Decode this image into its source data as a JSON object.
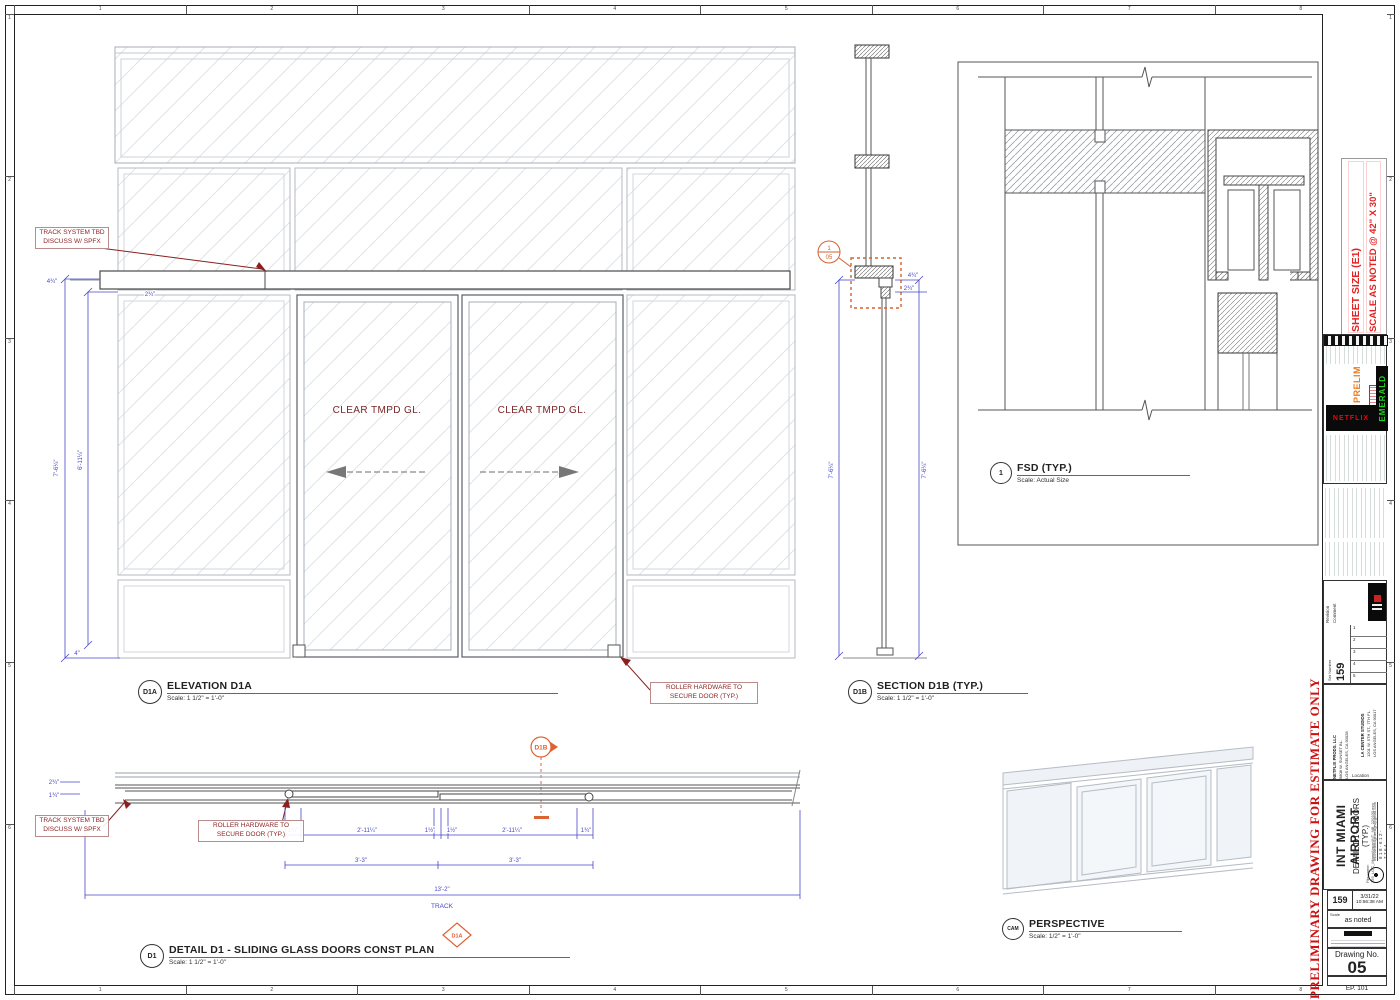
{
  "sheet": {
    "ruler_top": [
      "1",
      "2",
      "3",
      "4",
      "5",
      "6",
      "7",
      "8"
    ],
    "ruler_bottom": [
      "1",
      "2",
      "3",
      "4",
      "5",
      "6",
      "7",
      "8"
    ],
    "ruler_left": [
      "1",
      "2",
      "3",
      "4",
      "5",
      "6"
    ],
    "ruler_right": [
      "1",
      "2",
      "3",
      "4",
      "5",
      "6"
    ]
  },
  "colors": {
    "dim_blue": "#4747c9",
    "note_red": "#8b1f1f",
    "marker_orange": "#dd6333",
    "netflix_red": "#e50914",
    "emerald_green": "#22d022",
    "prelim_orange": "#e87c1e"
  },
  "annotations": {
    "track_note_1": "TRACK SYSTEM TBD",
    "track_note_2": "DISCUSS W/ SPFX",
    "roller_note_1": "ROLLER HARDWARE TO",
    "roller_note_2": "SECURE DOOR (TYP.)",
    "glass_label": "CLEAR TMPD GL.",
    "track_word": "TRACK"
  },
  "views": {
    "elevation": {
      "tag": "D1A",
      "title": "ELEVATION D1A",
      "scale": "Scale: 1 1/2\" = 1'-0\""
    },
    "section": {
      "tag": "D1B",
      "title": "SECTION D1B (TYP.)",
      "scale": "Scale: 1 1/2\" = 1'-0\"",
      "callout_top": "1",
      "callout_bottom": "05"
    },
    "fsd": {
      "tag": "1",
      "title": "FSD (TYP.)",
      "scale": "Scale: Actual Size"
    },
    "plan": {
      "tag": "D1",
      "title": "DETAIL D1 - SLIDING GLASS DOORS CONST PLAN",
      "scale": "Scale: 1 1/2\" = 1'-0\"",
      "marker_top": "D1B",
      "marker_bottom": "D1A"
    },
    "perspective": {
      "tag": "CAM",
      "title": "PERSPECTIVE",
      "scale": "Scale: 1/2\" = 1'-0\""
    }
  },
  "dims": {
    "elev_top_a": "4¾\"",
    "elev_top_b": "2¾\"",
    "elev_h_outer": "7'-6¼\"",
    "elev_h_inner": "6'-11¼\"",
    "elev_bottom": "4\"",
    "sect_a": "4¾\"",
    "sect_b": "2¾\"",
    "sect_h_left": "7'-6¼\"",
    "sect_h_right": "7'-6¼\"",
    "plan_small_a": "2¾\"",
    "plan_small_b": "1¾\"",
    "plan_end_l": "1¾\"",
    "plan_door_a": "2'-11¼\"",
    "plan_mid_a": "1½\"",
    "plan_mid_b": "1½\"",
    "plan_door_b": "2'-11¼\"",
    "plan_end_r": "1¾\"",
    "plan_panel_a": "3'-3\"",
    "plan_panel_b": "3'-3\"",
    "plan_track_len": "13'-2\""
  },
  "titleblock": {
    "sheet_size_1": "SHEET SIZE (E1)",
    "sheet_size_2": "SCALE AS NOTED @ 42\" X 30\"",
    "prelim": "PRELIM",
    "netflix": "NETFLIX",
    "emerald": "EMERALD",
    "rev_header": "Revision",
    "comment_header": "Comment",
    "rev_rows": [
      "1",
      "2",
      "3",
      "4",
      "5"
    ],
    "set_number_label": "Set Number",
    "set_number": "159",
    "addr1": [
      "LA CENTER STUDIOS",
      "1201 W. 5TH ST., 7TH FL",
      "LOS ANGELES, CA 90017"
    ],
    "addr2": [
      "NETFLIX PRODS. LLC",
      "5808 W. SUNSET BL.",
      "LOS ANGELES, CA 90028"
    ],
    "location_label": "Location",
    "set_name": "INT MIAMI AIRPORT",
    "sheet_title": "DETAIL D1 - DOORS (TYP.)",
    "file_name": "File name: 159_LOC_MiamiAirportINT_MB_220330.mm",
    "email": "michaelbridgedesign@gmail.com",
    "phone": "818-612-7764",
    "date": "3/31/22",
    "time": "10:56:38 AM",
    "scale_label": "Scale",
    "scale_value": "as noted",
    "drawing_no_label": "Drawing No.",
    "drawing_no": "05",
    "episode": "EP. 101",
    "preliminary": "PRELIMINARY DRAWING FOR ESTIMATE ONLY"
  }
}
